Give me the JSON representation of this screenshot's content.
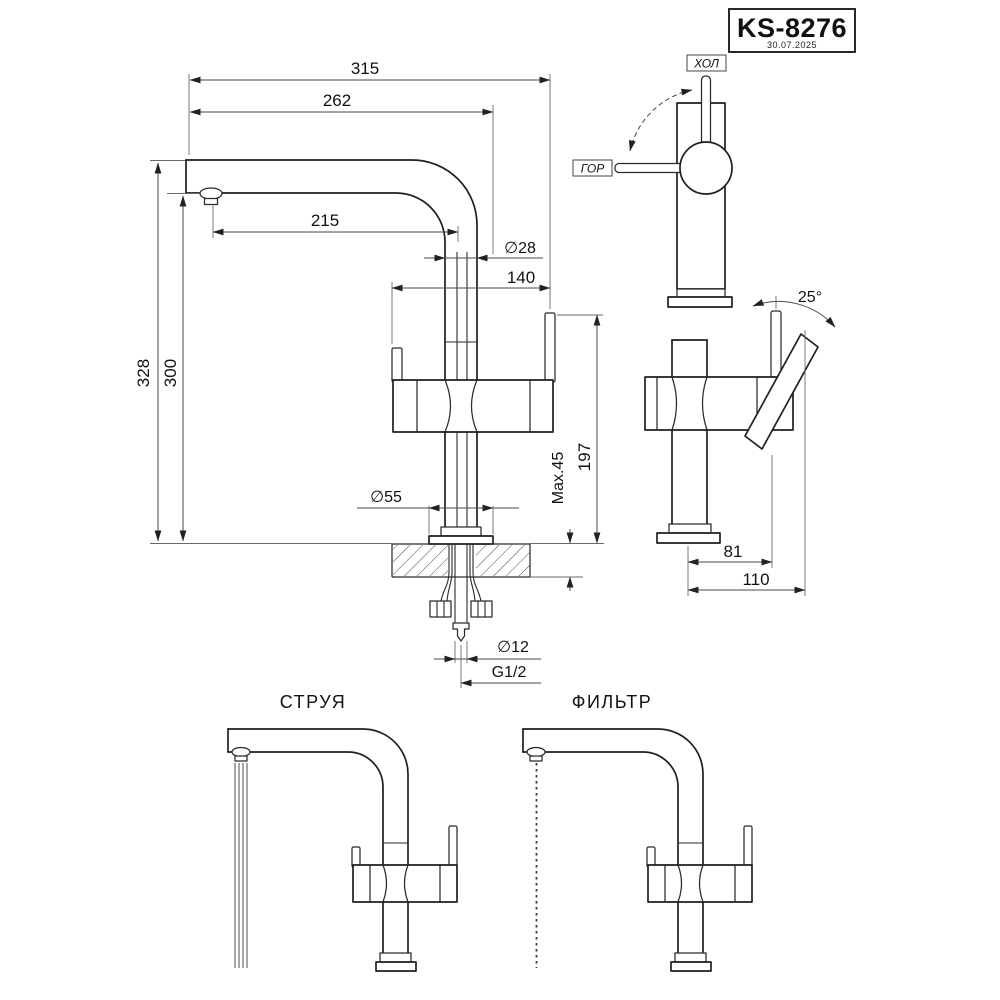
{
  "title_block": {
    "model": "KS-8276",
    "date": "30.07.2025"
  },
  "labels": {
    "cold_handle": "ХОЛ",
    "hot_handle": "ГОР",
    "view_stream": "СТРУЯ",
    "view_filter": "ФИЛЬТР"
  },
  "dimensions": {
    "total_reach": "315",
    "spout_reach_outer": "262",
    "spout_reach_inner": "215",
    "pipe_diameter": "∅28",
    "handle_span": "140",
    "total_height": "328",
    "spout_height": "300",
    "base_diameter": "∅55",
    "max_counter_thickness": "Max.45",
    "body_height": "197",
    "tube_diameter": "∅12",
    "thread_size": "G1/2",
    "handle_angle": "25°",
    "handle_offset": "81",
    "handle_reach": "110"
  }
}
